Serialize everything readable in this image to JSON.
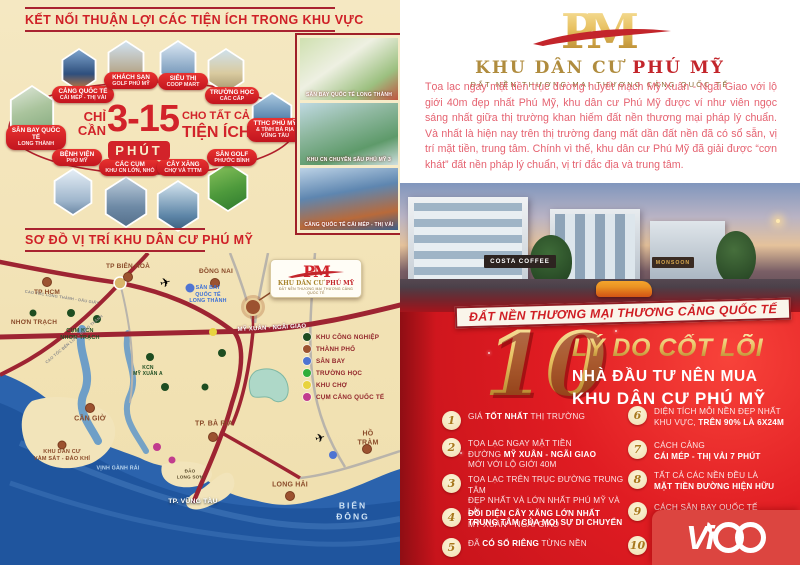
{
  "colors": {
    "primary_red": "#d6232a",
    "dark_red": "#8f1d24",
    "gold": "#cfa14a",
    "cream": "#f2e4ba",
    "sea_blue": "#2b5fa6"
  },
  "left": {
    "heading1": "KẾT NỐI THUẬN LỢI CÁC TIỆN ÍCH TRONG KHU VỰC",
    "heading2": "SƠ ĐỒ VỊ TRÍ KHU DÂN CƯ PHÚ MỸ",
    "center": {
      "chi_can": "CHỈ\nCẦN",
      "minutes": "3-15",
      "phut": "PHÚT",
      "cho_tat_ca": "CHO TẤT CẢ",
      "tien_ich": "TIỆN ÍCH"
    },
    "pills": [
      {
        "l1": "CẢNG QUỐC TẾ",
        "l2": "CÁI MÉP - THỊ VẢI"
      },
      {
        "l1": "KHÁCH SẠN",
        "l2": "GOLF PHÚ MỸ"
      },
      {
        "l1": "SIÊU THỊ",
        "l2": "COOP MART"
      },
      {
        "l1": "TRƯỜNG HỌC",
        "l2": "CÁC CẤP"
      },
      {
        "l1": "TTHC PHÚ MỸ",
        "l2": "& TỈNH BÀ RỊA\nVŨNG TÀU"
      },
      {
        "l1": "SÂN BAY QUỐC TẾ",
        "l2": "LONG THÀNH"
      },
      {
        "l1": "BỆNH VIỆN",
        "l2": "PHÚ MỸ"
      },
      {
        "l1": "CÁC CỤM",
        "l2": "KHU CN LỚN, NHỎ"
      },
      {
        "l1": "CÂY XĂNG",
        "l2": "CHỢ VÀ TTTM"
      },
      {
        "l1": "SÂN GOLF",
        "l2": "PHƯỚC BÌNH"
      }
    ],
    "thumbs": [
      {
        "caption": "SÂN BAY QUỐC TẾ LONG THÀNH"
      },
      {
        "caption": "KHU CN CHUYÊN SÂU PHÚ MỸ 3"
      },
      {
        "caption": "CẢNG QUỐC TẾ CÁI MÉP - THỊ VẢI"
      }
    ],
    "map": {
      "labels": [
        {
          "t": "TP HCM"
        },
        {
          "t": "TP BIÊN HOÀ"
        },
        {
          "t": "ĐỒNG NAI"
        },
        {
          "t": "NHƠN TRẠCH"
        },
        {
          "t": "CỤM KCN\nNHƠN TRẠCH"
        },
        {
          "t": "SÂN BAY\nQUỐC TẾ\nLONG THÀNH"
        },
        {
          "t": "KCN\nMỸ XUÂN A"
        },
        {
          "t": "MỸ XUÂN - NGÃI GIAO"
        },
        {
          "t": "CẦN GIỜ"
        },
        {
          "t": "KHU DÂN CƯ\nVÀM SÁT - ĐẢO KHỈ"
        },
        {
          "t": "TP. BÀ RỊA"
        },
        {
          "t": "ĐẢO\nLONG SƠN"
        },
        {
          "t": "VỊNH GÀNH RÁI"
        },
        {
          "t": "TP. VŨNG TÀU"
        },
        {
          "t": "LONG HẢI"
        },
        {
          "t": "HỒ TRÀM"
        },
        {
          "t": "BIỂN ĐÔNG"
        },
        {
          "t": "CAO TỐC LONG THÀNH - DẦU GIÂY"
        },
        {
          "t": "CAO TỐC BẾN LỨC - LONG THÀNH"
        }
      ],
      "legend": [
        {
          "label": "KHU CÔNG NGHIỆP",
          "color": "#1e4d21"
        },
        {
          "label": "THÀNH PHỐ",
          "color": "#9c5230"
        },
        {
          "label": "SÂN BAY",
          "color": "#4f74d2"
        },
        {
          "label": "TRƯỜNG HỌC",
          "color": "#2fae3a"
        },
        {
          "label": "KHU CHỢ",
          "color": "#e8d33f"
        },
        {
          "label": "CỤM CẢNG QUỐC TẾ",
          "color": "#c13c8e"
        }
      ],
      "callout": {
        "monogram": "PM",
        "title_gold": "KHU DÂN CƯ ",
        "title_red": "PHÚ MỸ",
        "tagline": "ĐẤT NỀN THƯƠNG MẠI THƯƠNG CẢNG QUỐC TẾ"
      }
    }
  },
  "right": {
    "logo": {
      "monogram_p": "P",
      "monogram_m": "M",
      "title_gold": "KHU DÂN CƯ",
      "title_red": " PHÚ MỸ",
      "tagline": "ĐẤT NỀN THƯƠNG MẠI THƯƠNG CẢNG QUỐC TẾ"
    },
    "intro": "Tọa lạc ngay mặt tiền trục đường huyết mạch Mỹ Xuân - Ngãi Giao với lộ giới 40m đẹp nhất Phú Mỹ, khu dân cư Phú Mỹ được ví như viên ngọc sáng nhất giữa thị trường khan hiếm đất nền thương mại pháp lý chuẩn. Và nhất là hiện nay trên thị trường đang mất dần đất nền đã có sổ sẵn, vị trí mặt tiền, trung tâm. Chính vì thế, khu dân cư Phú Mỹ đã giải được “cơn khát” đất nền pháp lý chuẩn, vị trí đắc địa và trung tâm.",
    "photo_signs": {
      "costa": "COSTA COFFEE",
      "monsoon": "MONSOON"
    },
    "banner": "ĐẤT NỀN THƯƠNG MẠI THƯƠNG CẢNG QUỐC TẾ",
    "ten": {
      "number": "10",
      "h1": "LÝ DO CỐT LÕI",
      "h2": "NHÀ ĐẦU TƯ NÊN MUA",
      "h3": "KHU DÂN CƯ PHÚ MỸ"
    },
    "reasons": [
      {
        "num": "1",
        "l1": {
          "pre": "GIÁ ",
          "bold": "TỐT NHẤT",
          "post": " THỊ TRƯỜNG"
        }
      },
      {
        "num": "2",
        "l1": {
          "pre": "TỌA LẠC NGAY MẶT TIỀN"
        },
        "l2": {
          "pre": "ĐƯỜNG ",
          "bold": "MỸ XUÂN - NGÃI GIAO"
        },
        "l3": {
          "pre": "MỚI VỚI LỘ GIỚI 40M"
        }
      },
      {
        "num": "3",
        "l1": {
          "pre": "TỌA LẠC TRÊN TRỤC ĐƯỜNG TRUNG TÂM"
        },
        "l2": {
          "pre": "ĐẸP NHẤT VÀ LỚN NHẤT PHÚ MỸ VÀ LÀ"
        },
        "l3": {
          "bold": "TRUNG TÂM CỦA MỌI SỰ DI CHUYỂN"
        }
      },
      {
        "num": "4",
        "l1": {
          "bold": "ĐỐI DIỆN CÂY XĂNG LỚN NHẤT"
        },
        "l2": {
          "pre": "MỸ XUÂN - NGÃI GIAO"
        }
      },
      {
        "num": "5",
        "l1": {
          "pre": "ĐÃ ",
          "bold": "CÓ SỔ RIÊNG",
          "post": " TỪNG NỀN"
        }
      },
      {
        "num": "6",
        "l1": {
          "pre": "DIỆN TÍCH MỖI NỀN ĐẸP NHẤT"
        },
        "l2": {
          "pre": "KHU VỰC, ",
          "bold": "TRÊN 90% LÀ 6X24M"
        }
      },
      {
        "num": "7",
        "l1": {
          "pre": "CÁCH CẢNG"
        },
        "l2": {
          "bold": "CÁI MÉP - THỊ VẢI 7 PHÚT"
        }
      },
      {
        "num": "8",
        "l1": {
          "pre": "TẤT CẢ CÁC NỀN ĐỀU LÀ"
        },
        "l2": {
          "bold": "MẶT TIỀN ĐƯỜNG HIỆN HỮU"
        }
      },
      {
        "num": "9",
        "l1": {
          "pre": "CÁCH SÂN BAY QUỐC TẾ"
        },
        "l2": {
          "pre": "LONG THÀNH"
        }
      },
      {
        "num": "10",
        "l1": {
          "pre": "NGÂN HÀNG"
        }
      }
    ],
    "brand": {
      "name": "Vico",
      "visual_prefix": "Vi"
    }
  }
}
